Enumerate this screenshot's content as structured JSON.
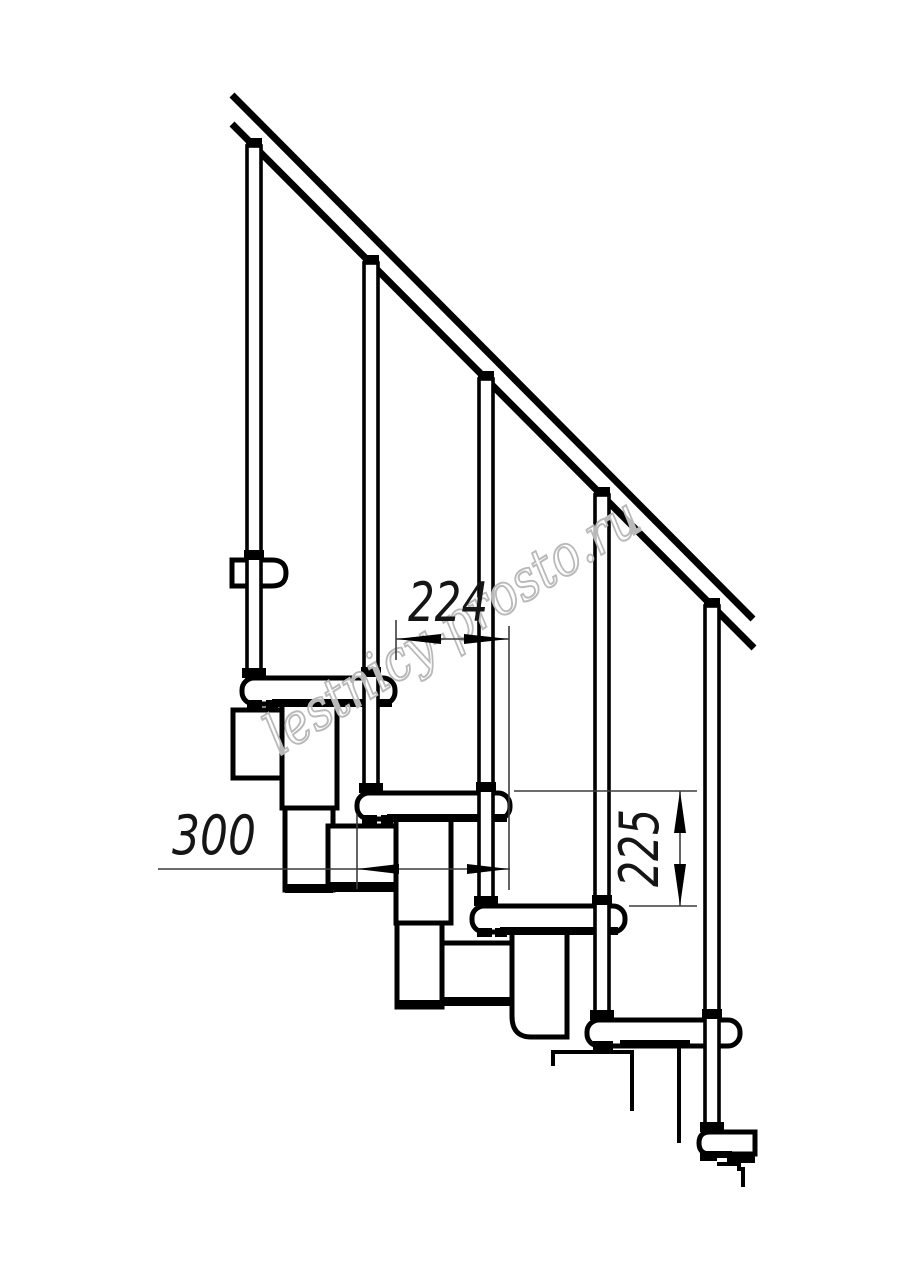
{
  "page": {
    "background_color": "#ffffff",
    "description": "Technical side-view drawing of a modular staircase with handrail, balusters and treads"
  },
  "drawing": {
    "line_color": "#000000",
    "thin_line_color": "#3c3c3c",
    "watermark": {
      "text": "lestnicy-prosto.ru",
      "color": "#b9b9b9",
      "angle_deg": -32
    },
    "elements": {
      "handrail": "handrail",
      "balusters_count": 5,
      "treads_count": 5
    },
    "dimensions": [
      {
        "id": "going",
        "label": "224",
        "orientation": "horizontal",
        "meaning": "step going between tread noses"
      },
      {
        "id": "tread_depth",
        "label": "300",
        "orientation": "horizontal",
        "meaning": "tread depth"
      },
      {
        "id": "rise",
        "label": "225",
        "orientation": "vertical",
        "meaning": "step rise"
      }
    ]
  }
}
